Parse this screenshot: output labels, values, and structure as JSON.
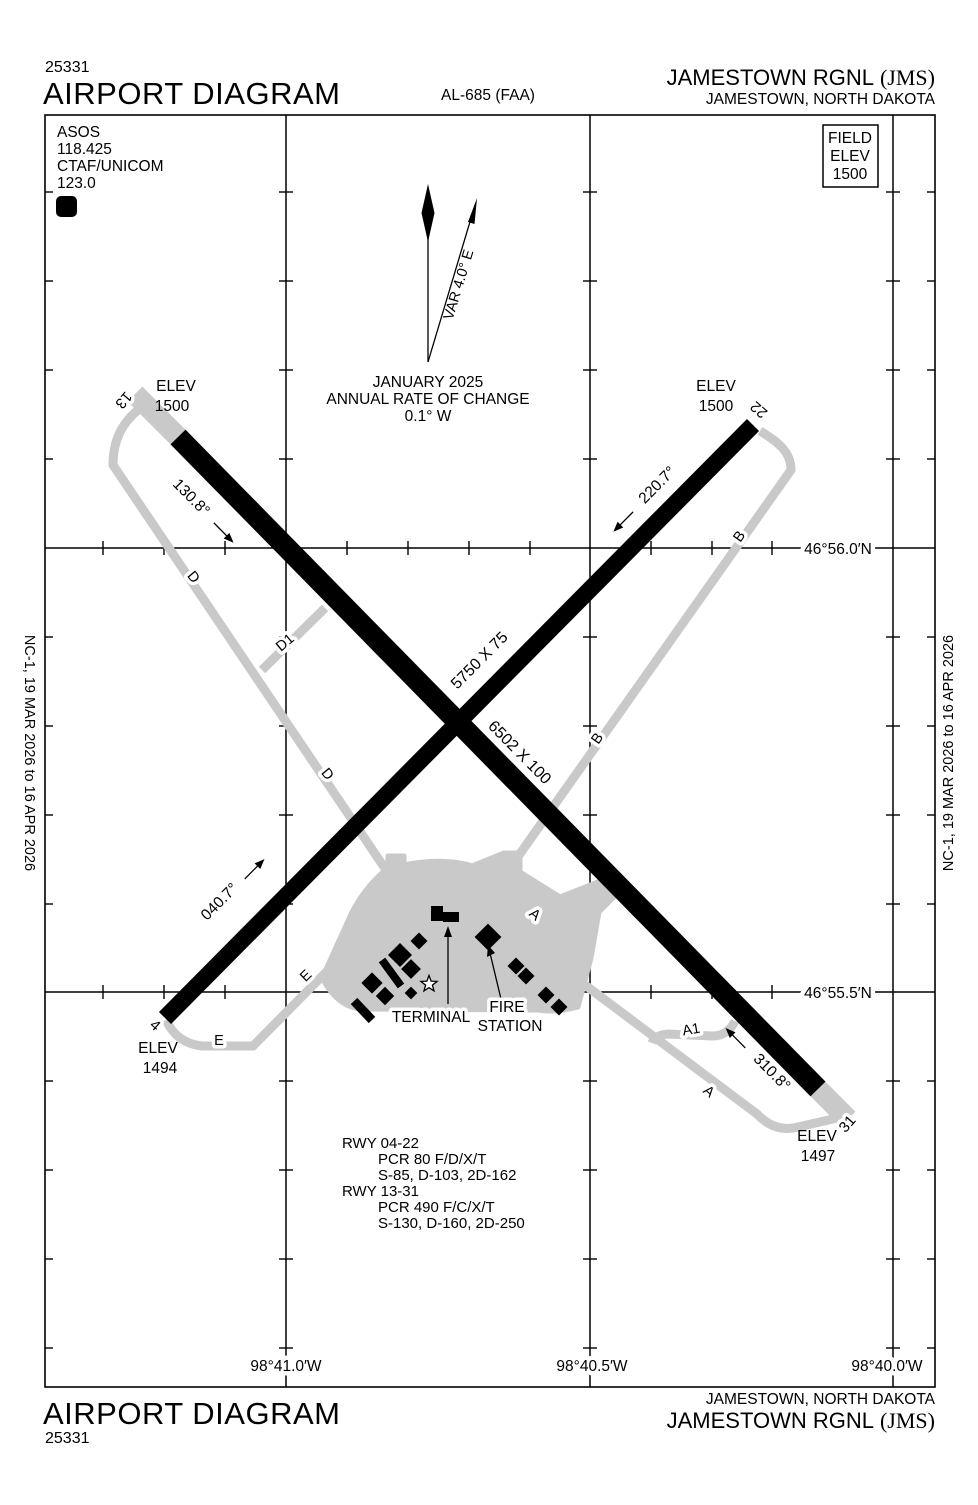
{
  "header": {
    "page_code": "25331",
    "title": "AIRPORT DIAGRAM",
    "al_number": "AL-685 (FAA)",
    "airport": "JAMESTOWN RGNL",
    "code": "(JMS)",
    "city": "JAMESTOWN, NORTH DAKOTA"
  },
  "footer": {
    "title": "AIRPORT DIAGRAM",
    "page_code": "25331",
    "airport": "JAMESTOWN RGNL",
    "code": "(JMS)",
    "city": "JAMESTOWN, NORTH DAKOTA"
  },
  "edition": {
    "note": "NC-1,  19 MAR 2026  to  16 APR 2026"
  },
  "comm": {
    "asos_label": "ASOS",
    "asos_freq": "118.425",
    "ctaf_label": "CTAF/UNICOM",
    "ctaf_freq": "123.0",
    "notam_symbol": "D"
  },
  "field_elev": {
    "line1": "FIELD",
    "line2": "ELEV",
    "line3": "1500"
  },
  "compass": {
    "variation": "VAR 4.0° E",
    "date": "JANUARY 2025",
    "rate_label": "ANNUAL RATE OF CHANGE",
    "rate_value": "0.1° W"
  },
  "grid": {
    "lat_56_0": "46°56.0′N",
    "lat_55_5": "46°55.5′N",
    "lon_41_0": "98°41.0′W",
    "lon_40_5": "98°40.5′W",
    "lon_40_0": "98°40.0′W"
  },
  "runways": {
    "elev_label": "ELEV",
    "num_13": "13",
    "num_31": "31",
    "num_04": "4",
    "num_22": "22",
    "dim_13_31": "6502 X 100",
    "dim_04_22": "5750 X 75",
    "hdg_13": "130.8°",
    "hdg_22": "220.7°",
    "hdg_04": "040.7°",
    "hdg_31": "310.8°",
    "elev_13": "1500",
    "elev_22": "1500",
    "elev_04": "1494",
    "elev_31": "1497"
  },
  "taxiways": {
    "a": "A",
    "a1": "A1",
    "b": "B",
    "d": "D",
    "d1": "D1",
    "e": "E"
  },
  "facilities": {
    "terminal": "TERMINAL",
    "fire_line1": "FIRE",
    "fire_line2": "STATION"
  },
  "runway_data": [
    "RWY 04-22",
    "PCR 80 F/D/X/T",
    "S-85, D-103, 2D-162",
    "RWY 13-31",
    "PCR 490 F/C/X/T",
    "S-130, D-160, 2D-250"
  ],
  "colors": {
    "pavement_gray": "#c9c9c9",
    "ink": "#000000"
  }
}
